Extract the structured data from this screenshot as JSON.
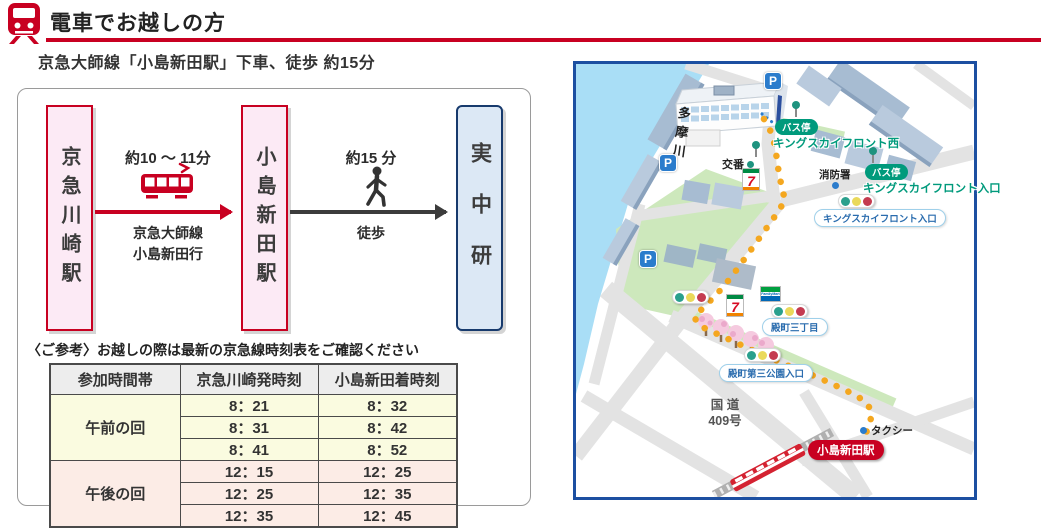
{
  "header": {
    "title": "電車でお越しの方",
    "subtitle": "京急大師線「小島新田駅」下車、徒歩 約15分"
  },
  "diagram": {
    "origin": "京急川崎駅",
    "via": "小島新田駅",
    "destination": "実中研",
    "leg_train": {
      "duration": "約10 ～ 11分",
      "line": "京急大師線",
      "bound": "小島新田行"
    },
    "leg_walk": {
      "duration": "約15 分",
      "mode": "徒歩"
    },
    "note": "〈ご参考〉お越しの際は最新の京急線時刻表をご確認ください"
  },
  "timetable": {
    "col_time_slot": "参加時間帯",
    "col_depart": "京急川崎発時刻",
    "col_arrive": "小島新田着時刻",
    "groups": [
      {
        "label": "午前の回",
        "rows": [
          {
            "dep": "8：21",
            "arr": "8：32"
          },
          {
            "dep": "8：31",
            "arr": "8：42"
          },
          {
            "dep": "8：41",
            "arr": "8：52"
          }
        ]
      },
      {
        "label": "午後の回",
        "rows": [
          {
            "dep": "12：15",
            "arr": "12：25"
          },
          {
            "dep": "12：25",
            "arr": "12：35"
          },
          {
            "dep": "12：35",
            "arr": "12：45"
          }
        ]
      }
    ]
  },
  "map": {
    "river": "多摩川",
    "parking": "P",
    "police_box": "交番",
    "fire_station": "消防署",
    "bus_stop_badge": "バス停",
    "bus_stop_west": "キングスカイフロント西",
    "bus_stop_entrance": "キングスカイフロント入口",
    "crossing_kings_entrance": "キングスカイフロント入口",
    "crossing_tonomachi3": "殿町三丁目",
    "crossing_tonomachi_park": "殿町第三公園入口",
    "national_route_line1": "国 道",
    "national_route_line2": "409号",
    "taxi": "タクシー",
    "station": "小島新田駅",
    "seven_eleven": "7",
    "familymart": "FamilyMart"
  },
  "colors": {
    "accent_red": "#c80021",
    "map_border_blue": "#1c4fa1",
    "route_orange": "#f4a71f",
    "bus_green": "#009a7c"
  }
}
